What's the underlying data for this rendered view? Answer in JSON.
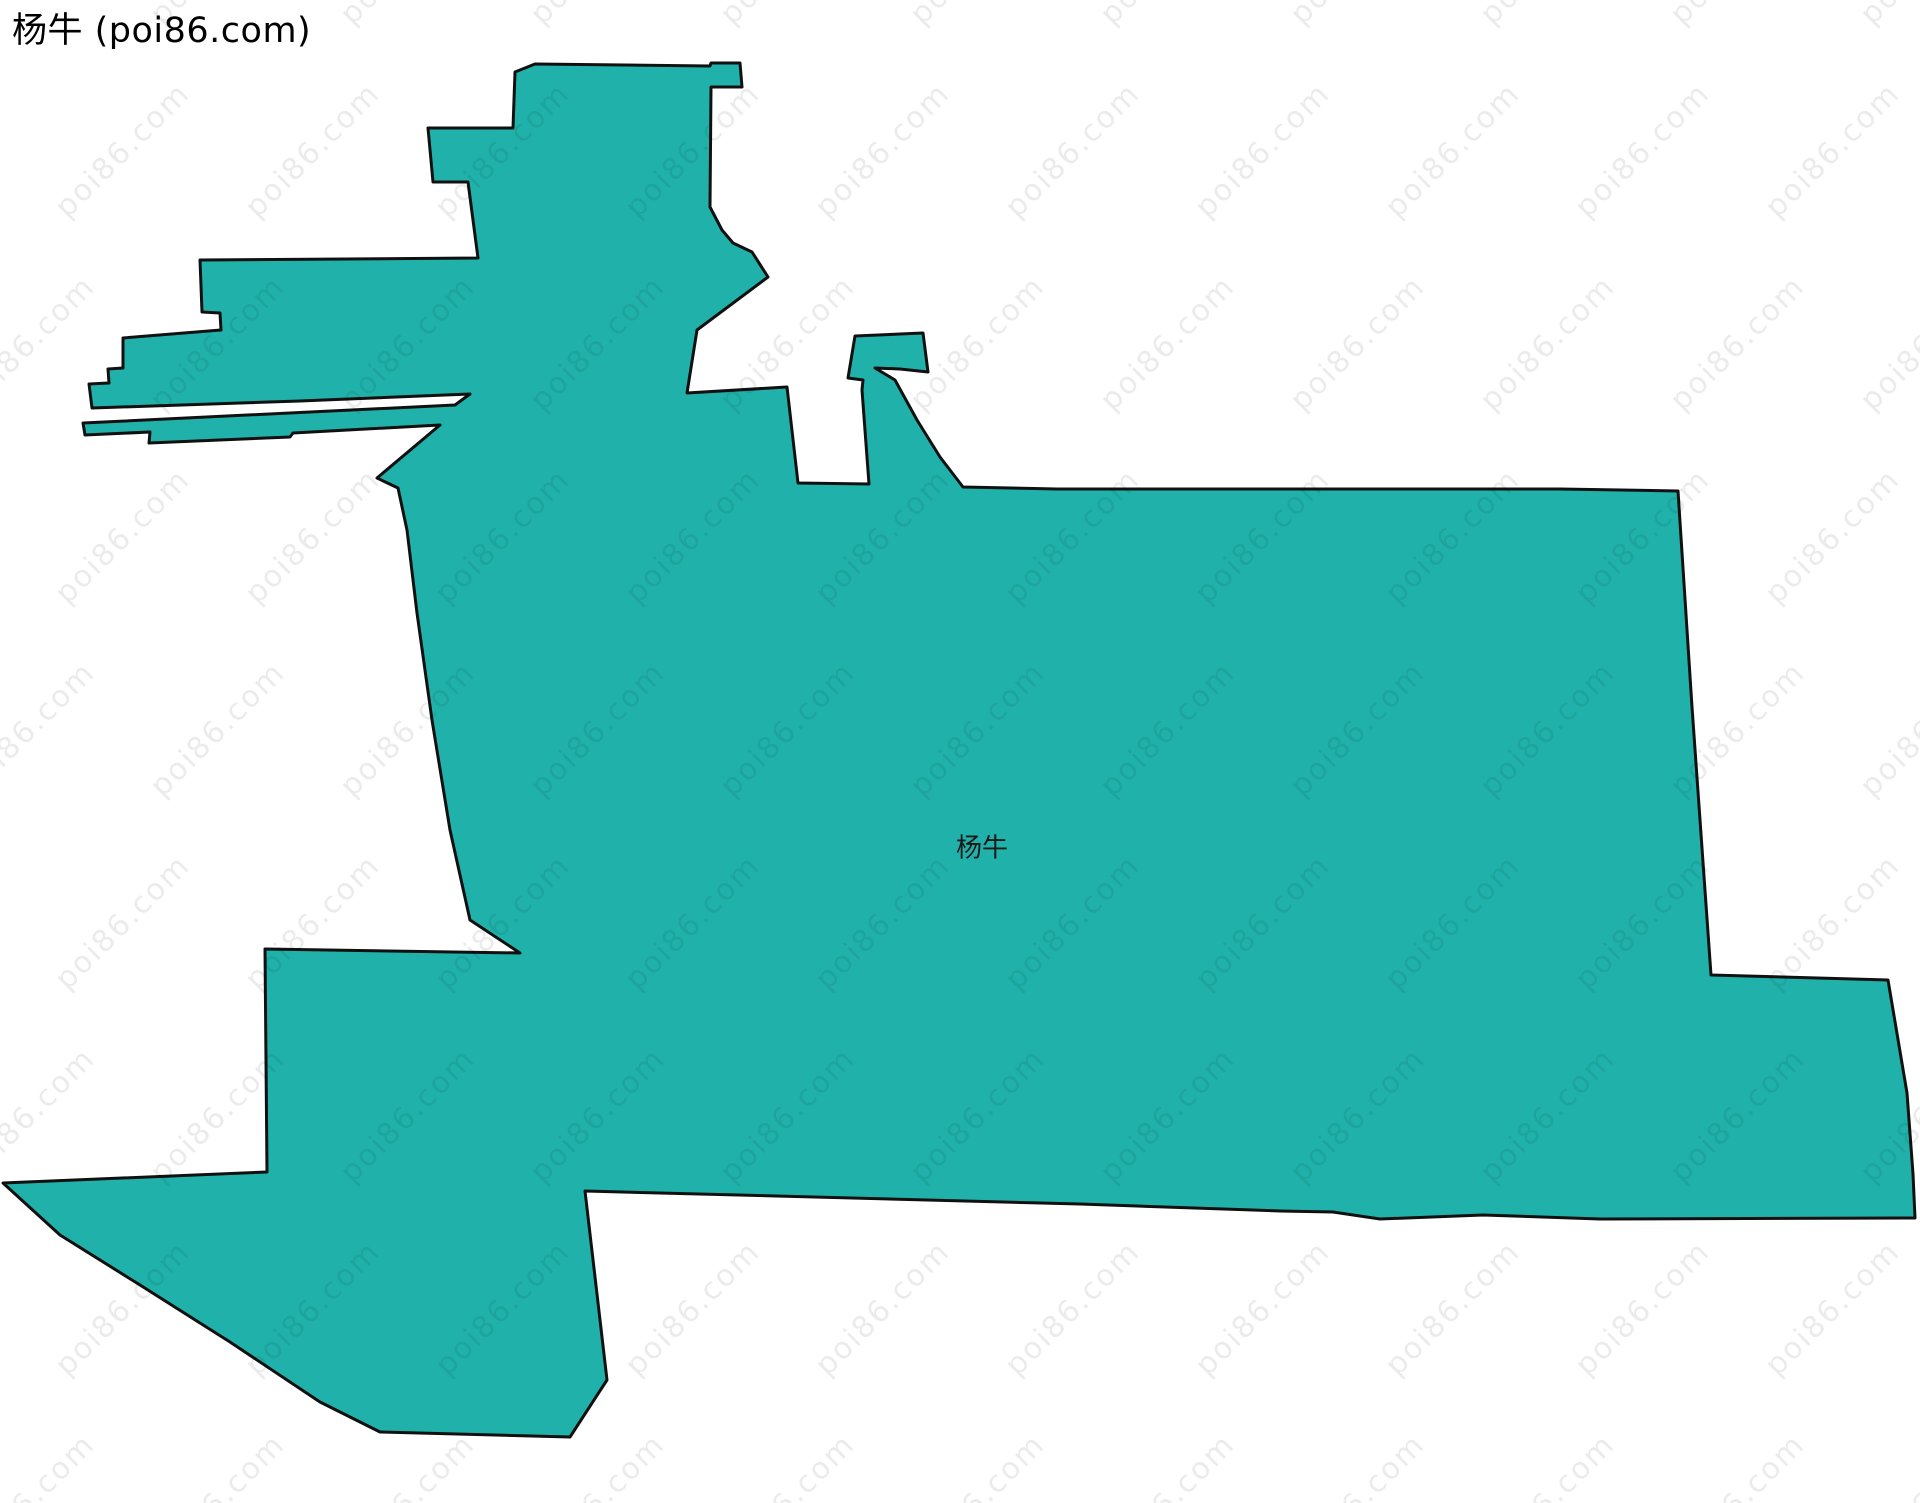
{
  "page_title": "杨牛 (poi86.com)",
  "map": {
    "region_label": "杨牛",
    "label_position": {
      "x": 982,
      "y": 846
    },
    "fill_color": "#20B2AA",
    "stroke_color": "#101010",
    "background_color": "#ffffff",
    "outline_points": [
      [
        515,
        72
      ],
      [
        535,
        64
      ],
      [
        710,
        66
      ],
      [
        711,
        63
      ],
      [
        740,
        63
      ],
      [
        742,
        87
      ],
      [
        711,
        87
      ],
      [
        710,
        207
      ],
      [
        722,
        230
      ],
      [
        733,
        243
      ],
      [
        752,
        252
      ],
      [
        768,
        277
      ],
      [
        697,
        330
      ],
      [
        687,
        393
      ],
      [
        787,
        387
      ],
      [
        798,
        483
      ],
      [
        869,
        484
      ],
      [
        862,
        390
      ],
      [
        863,
        380
      ],
      [
        848,
        378
      ],
      [
        855,
        336
      ],
      [
        923,
        333
      ],
      [
        928,
        372
      ],
      [
        900,
        369
      ],
      [
        875,
        368
      ],
      [
        895,
        380
      ],
      [
        917,
        420
      ],
      [
        940,
        457
      ],
      [
        963,
        487
      ],
      [
        1057,
        489
      ],
      [
        1560,
        489
      ],
      [
        1678,
        491
      ],
      [
        1692,
        707
      ],
      [
        1711,
        975
      ],
      [
        1888,
        980
      ],
      [
        1907,
        1093
      ],
      [
        1913,
        1174
      ],
      [
        1915,
        1218
      ],
      [
        1600,
        1219
      ],
      [
        1483,
        1215
      ],
      [
        1380,
        1219
      ],
      [
        1333,
        1212
      ],
      [
        1280,
        1211
      ],
      [
        1080,
        1204
      ],
      [
        585,
        1191
      ],
      [
        607,
        1380
      ],
      [
        570,
        1437
      ],
      [
        380,
        1432
      ],
      [
        320,
        1402
      ],
      [
        230,
        1342
      ],
      [
        140,
        1285
      ],
      [
        60,
        1235
      ],
      [
        3,
        1183
      ],
      [
        267,
        1172
      ],
      [
        265,
        949
      ],
      [
        520,
        953
      ],
      [
        470,
        920
      ],
      [
        450,
        830
      ],
      [
        432,
        720
      ],
      [
        417,
        613
      ],
      [
        407,
        530
      ],
      [
        398,
        488
      ],
      [
        377,
        478
      ],
      [
        440,
        425
      ],
      [
        293,
        433
      ],
      [
        290,
        437
      ],
      [
        149,
        443
      ],
      [
        150,
        432
      ],
      [
        85,
        435
      ],
      [
        83,
        423
      ],
      [
        455,
        405
      ],
      [
        470,
        394
      ],
      [
        300,
        401
      ],
      [
        92,
        408
      ],
      [
        89,
        384
      ],
      [
        109,
        383
      ],
      [
        108,
        369
      ],
      [
        123,
        368
      ],
      [
        123,
        338
      ],
      [
        221,
        330
      ],
      [
        220,
        313
      ],
      [
        202,
        312
      ],
      [
        200,
        260
      ],
      [
        478,
        258
      ],
      [
        468,
        182
      ],
      [
        433,
        182
      ],
      [
        428,
        128
      ],
      [
        513,
        128
      ]
    ]
  },
  "watermark": {
    "text": "poi86.com"
  }
}
